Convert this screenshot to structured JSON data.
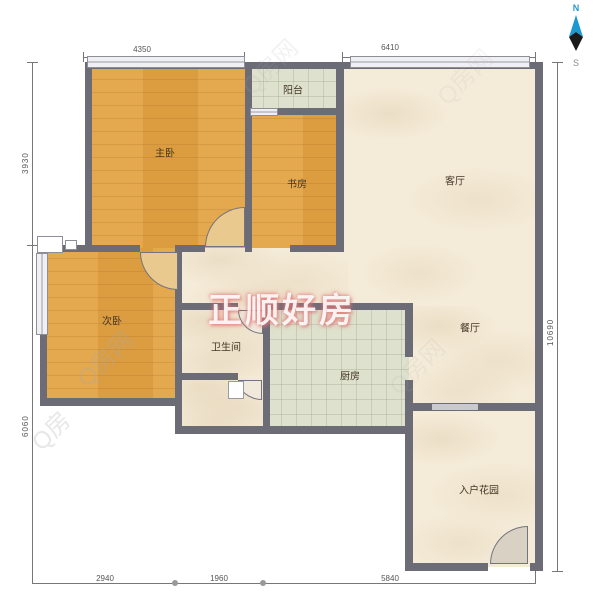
{
  "compass": {
    "north": "N",
    "south": "S"
  },
  "watermarks": {
    "center": "正顺好房",
    "diagonal": "Q房网",
    "diagonal_short": "Q房"
  },
  "rooms": {
    "master": "主卧",
    "study": "书房",
    "balcony": "阳台",
    "living": "客厅",
    "dining": "餐厅",
    "second_bedroom": "次卧",
    "bathroom": "卫生间",
    "kitchen": "厨房",
    "entry_garden": "入户花园"
  },
  "dimensions": {
    "top_left": "4350",
    "top_right": "6410",
    "left_upper": "3930",
    "left_lower": "6060",
    "right_side": "10690",
    "bottom_left": "2940",
    "bottom_middle": "1960",
    "bottom_right": "5840"
  },
  "colors": {
    "wall": "#6c6c77",
    "wood_floor": "#e3a445",
    "tile_floor": "#dee1cd",
    "marble_floor": "#f4ebd8",
    "north_accent": "#2499cf"
  }
}
